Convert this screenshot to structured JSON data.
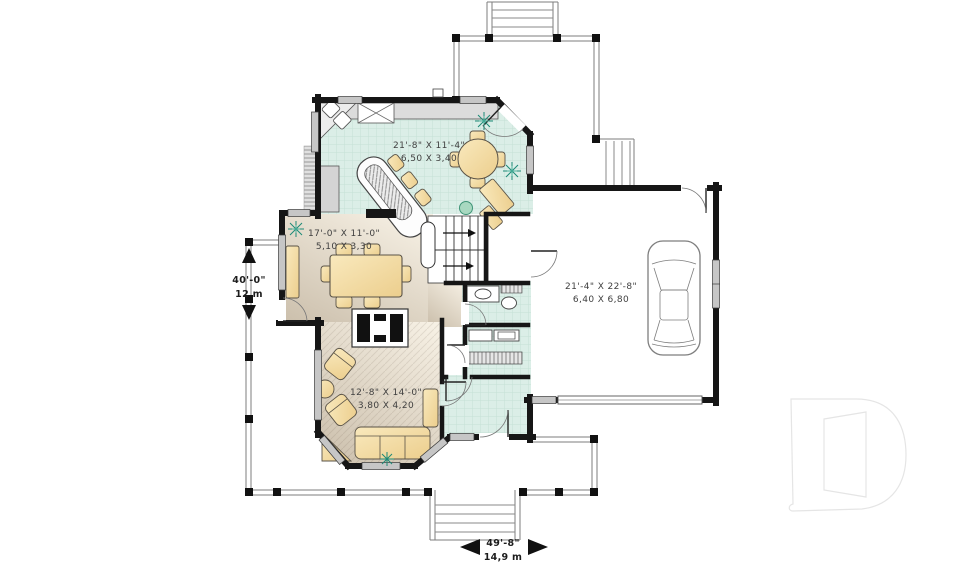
{
  "page": {
    "title": "First floor plan"
  },
  "rooms": [
    {
      "id": "kitchen-breakfast",
      "imperial": "21'-8\" X 11'-4\"",
      "metric": "6,50 X 3,40"
    },
    {
      "id": "dining-room",
      "imperial": "17'-0\" X 11'-0\"",
      "metric": "5,10 X 3,30"
    },
    {
      "id": "living-room",
      "imperial": "12'-8\" X 14'-0\"",
      "metric": "3,80 X 4,20"
    },
    {
      "id": "garage",
      "imperial": "21'-4\" X 22'-8\"",
      "metric": "6,40 X 6,80"
    }
  ],
  "dimensions": {
    "vertical": {
      "imperial": "40'-0\"",
      "metric": "12 m"
    },
    "horizontal": {
      "imperial": "49'-8\"",
      "metric": "14,9 m"
    }
  },
  "watermark": {
    "logo": "D"
  },
  "colors": {
    "tile_floor": "#dbeee7",
    "tile_grid": "#c5e0d6",
    "wood_floor_light": "#f6f0e4",
    "wood_floor_dark": "#cdc1ae",
    "wall": "#161616",
    "furniture": "#f6dfa4",
    "counter": "#dcdcdc",
    "plant": "#1d8a77",
    "watermark": "#e5e5e5"
  }
}
